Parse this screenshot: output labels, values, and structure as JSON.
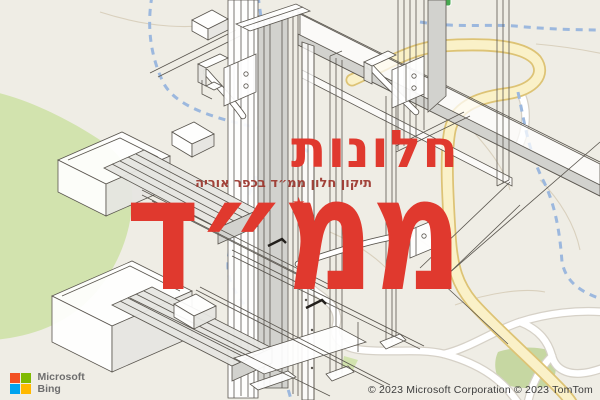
{
  "overlay": {
    "heading": "חלונות",
    "subheading": "תיקון חלון ממ״ד בכפר אוריה",
    "big_word": "ממ״ד",
    "star_glyph": "★",
    "accent_color": "#e0392e",
    "subheading_color": "#9c352c"
  },
  "branding": {
    "name_top": "Microsoft",
    "name_bottom": "Bing",
    "squares": {
      "tl": "#f25022",
      "tr": "#7fba00",
      "bl": "#00a4ef",
      "br": "#ffb900"
    }
  },
  "attribution": {
    "text": "© 2023 Microsoft Corporation © 2023 TomTom"
  },
  "map": {
    "land_color": "#efede5",
    "green_area_color": "#d2e3ae",
    "park_color": "#c6d7a2",
    "road_major_fill": "#faf1c8",
    "road_major_casing": "#ddc375",
    "road_minor_fill": "#ffffff",
    "road_minor_casing": "#d6d1c7",
    "stream_color": "#9cb8de",
    "contour_color": "#d9d0bd",
    "marker_color": "#46a94f"
  }
}
